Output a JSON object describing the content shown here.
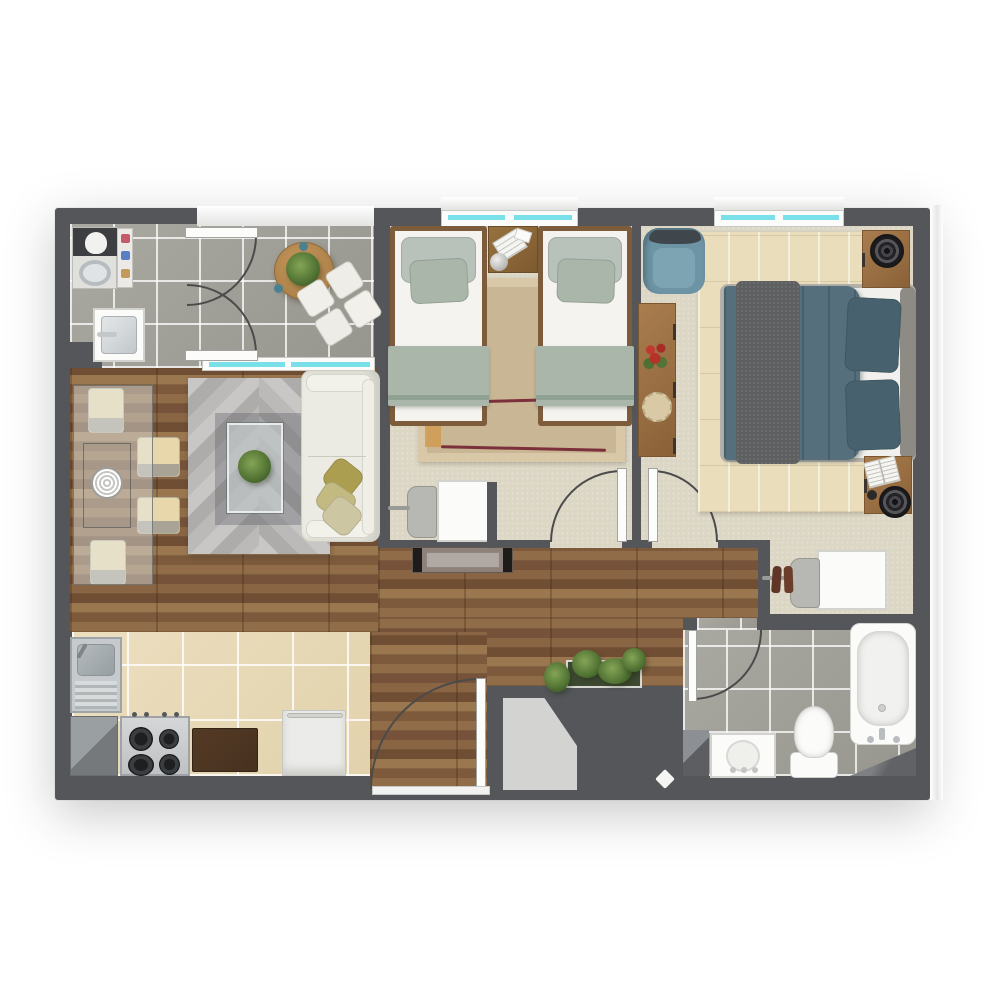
{
  "title": "Two-bedroom apartment floor plan (top-down 3D render)",
  "palette": {
    "wall": "#54565a",
    "grayTile": "#a3a29a",
    "beigeTile": "#e9dbb9",
    "woodFloor": "#8a6544",
    "carpet": "#dcd6c5",
    "windowGlass": "#79dfe9",
    "sage": "#a9b6a9",
    "sofaCream": "#ecebe3",
    "oliveDark": "#ac9e50",
    "oliveMid": "#c3ba82",
    "olivePale": "#cdc6a2",
    "masterTeal": "#55707c",
    "pillowTeal": "#47626e",
    "throwGray": "#5e5f61",
    "armchairTeal": "#6d94a5",
    "furnitureWood": "#996f44",
    "bedFrameWood": "#7d5c3c",
    "rugTan": "#c9b695",
    "rugTanBorder": "#d9c8a8",
    "maroon": "#7c303a",
    "masterRug": "#e9ddbb",
    "steel": "#c6cacc",
    "darkBoard": "#47311f",
    "entryMat": "#d3d3d1"
  },
  "rooms": [
    {
      "name": "Balcony and laundry",
      "floor": "gray tile",
      "items": [
        "washing machine",
        "laundry shelf",
        "utility sink",
        "french doors",
        "round table",
        "potted plant",
        "ottoman set"
      ]
    },
    {
      "name": "Living and dining room",
      "floor": "wood plank",
      "items": [
        "glass dining table",
        "four dining chairs",
        "spiral centerpiece plate",
        "chevron rug",
        "glass coffee table",
        "houseplant",
        "cream sofa",
        "three olive pillows",
        "media console"
      ]
    },
    {
      "name": "Kids bedroom",
      "floor": "carpet",
      "items": [
        "twin bed left",
        "twin bed right",
        "nightstand",
        "ball lamp",
        "books",
        "striped rug",
        "desk",
        "desk chair"
      ]
    },
    {
      "name": "Master bedroom",
      "floor": "carpet",
      "items": [
        "double bed",
        "two teal pillows",
        "gray throw",
        "nightstand top",
        "nightstand bottom",
        "two speaker lamps",
        "open book",
        "armchair",
        "dresser console",
        "flower vase",
        "woven plate",
        "striped rug",
        "desk",
        "desk chair",
        "pair of shoes"
      ]
    },
    {
      "name": "Kitchen",
      "floor": "beige tile",
      "items": [
        "sink with drainboard",
        "corner counter",
        "four burner stove",
        "dark counter board",
        "refrigerator"
      ]
    },
    {
      "name": "Bathroom",
      "floor": "gray tile",
      "items": [
        "bathtub",
        "toilet",
        "vanity sink"
      ]
    },
    {
      "name": "Hallway and entry",
      "floor": "wood plank",
      "items": [
        "planter box",
        "entry mat",
        "door peephole marker"
      ]
    }
  ],
  "openings": {
    "windows": [
      {
        "name": "kids bedroom window"
      },
      {
        "name": "master bedroom window"
      },
      {
        "name": "living room window to balcony"
      }
    ],
    "doors": [
      {
        "name": "balcony french doors"
      },
      {
        "name": "kids bedroom door"
      },
      {
        "name": "master bedroom door"
      },
      {
        "name": "bathroom door"
      },
      {
        "name": "entry door"
      }
    ]
  }
}
